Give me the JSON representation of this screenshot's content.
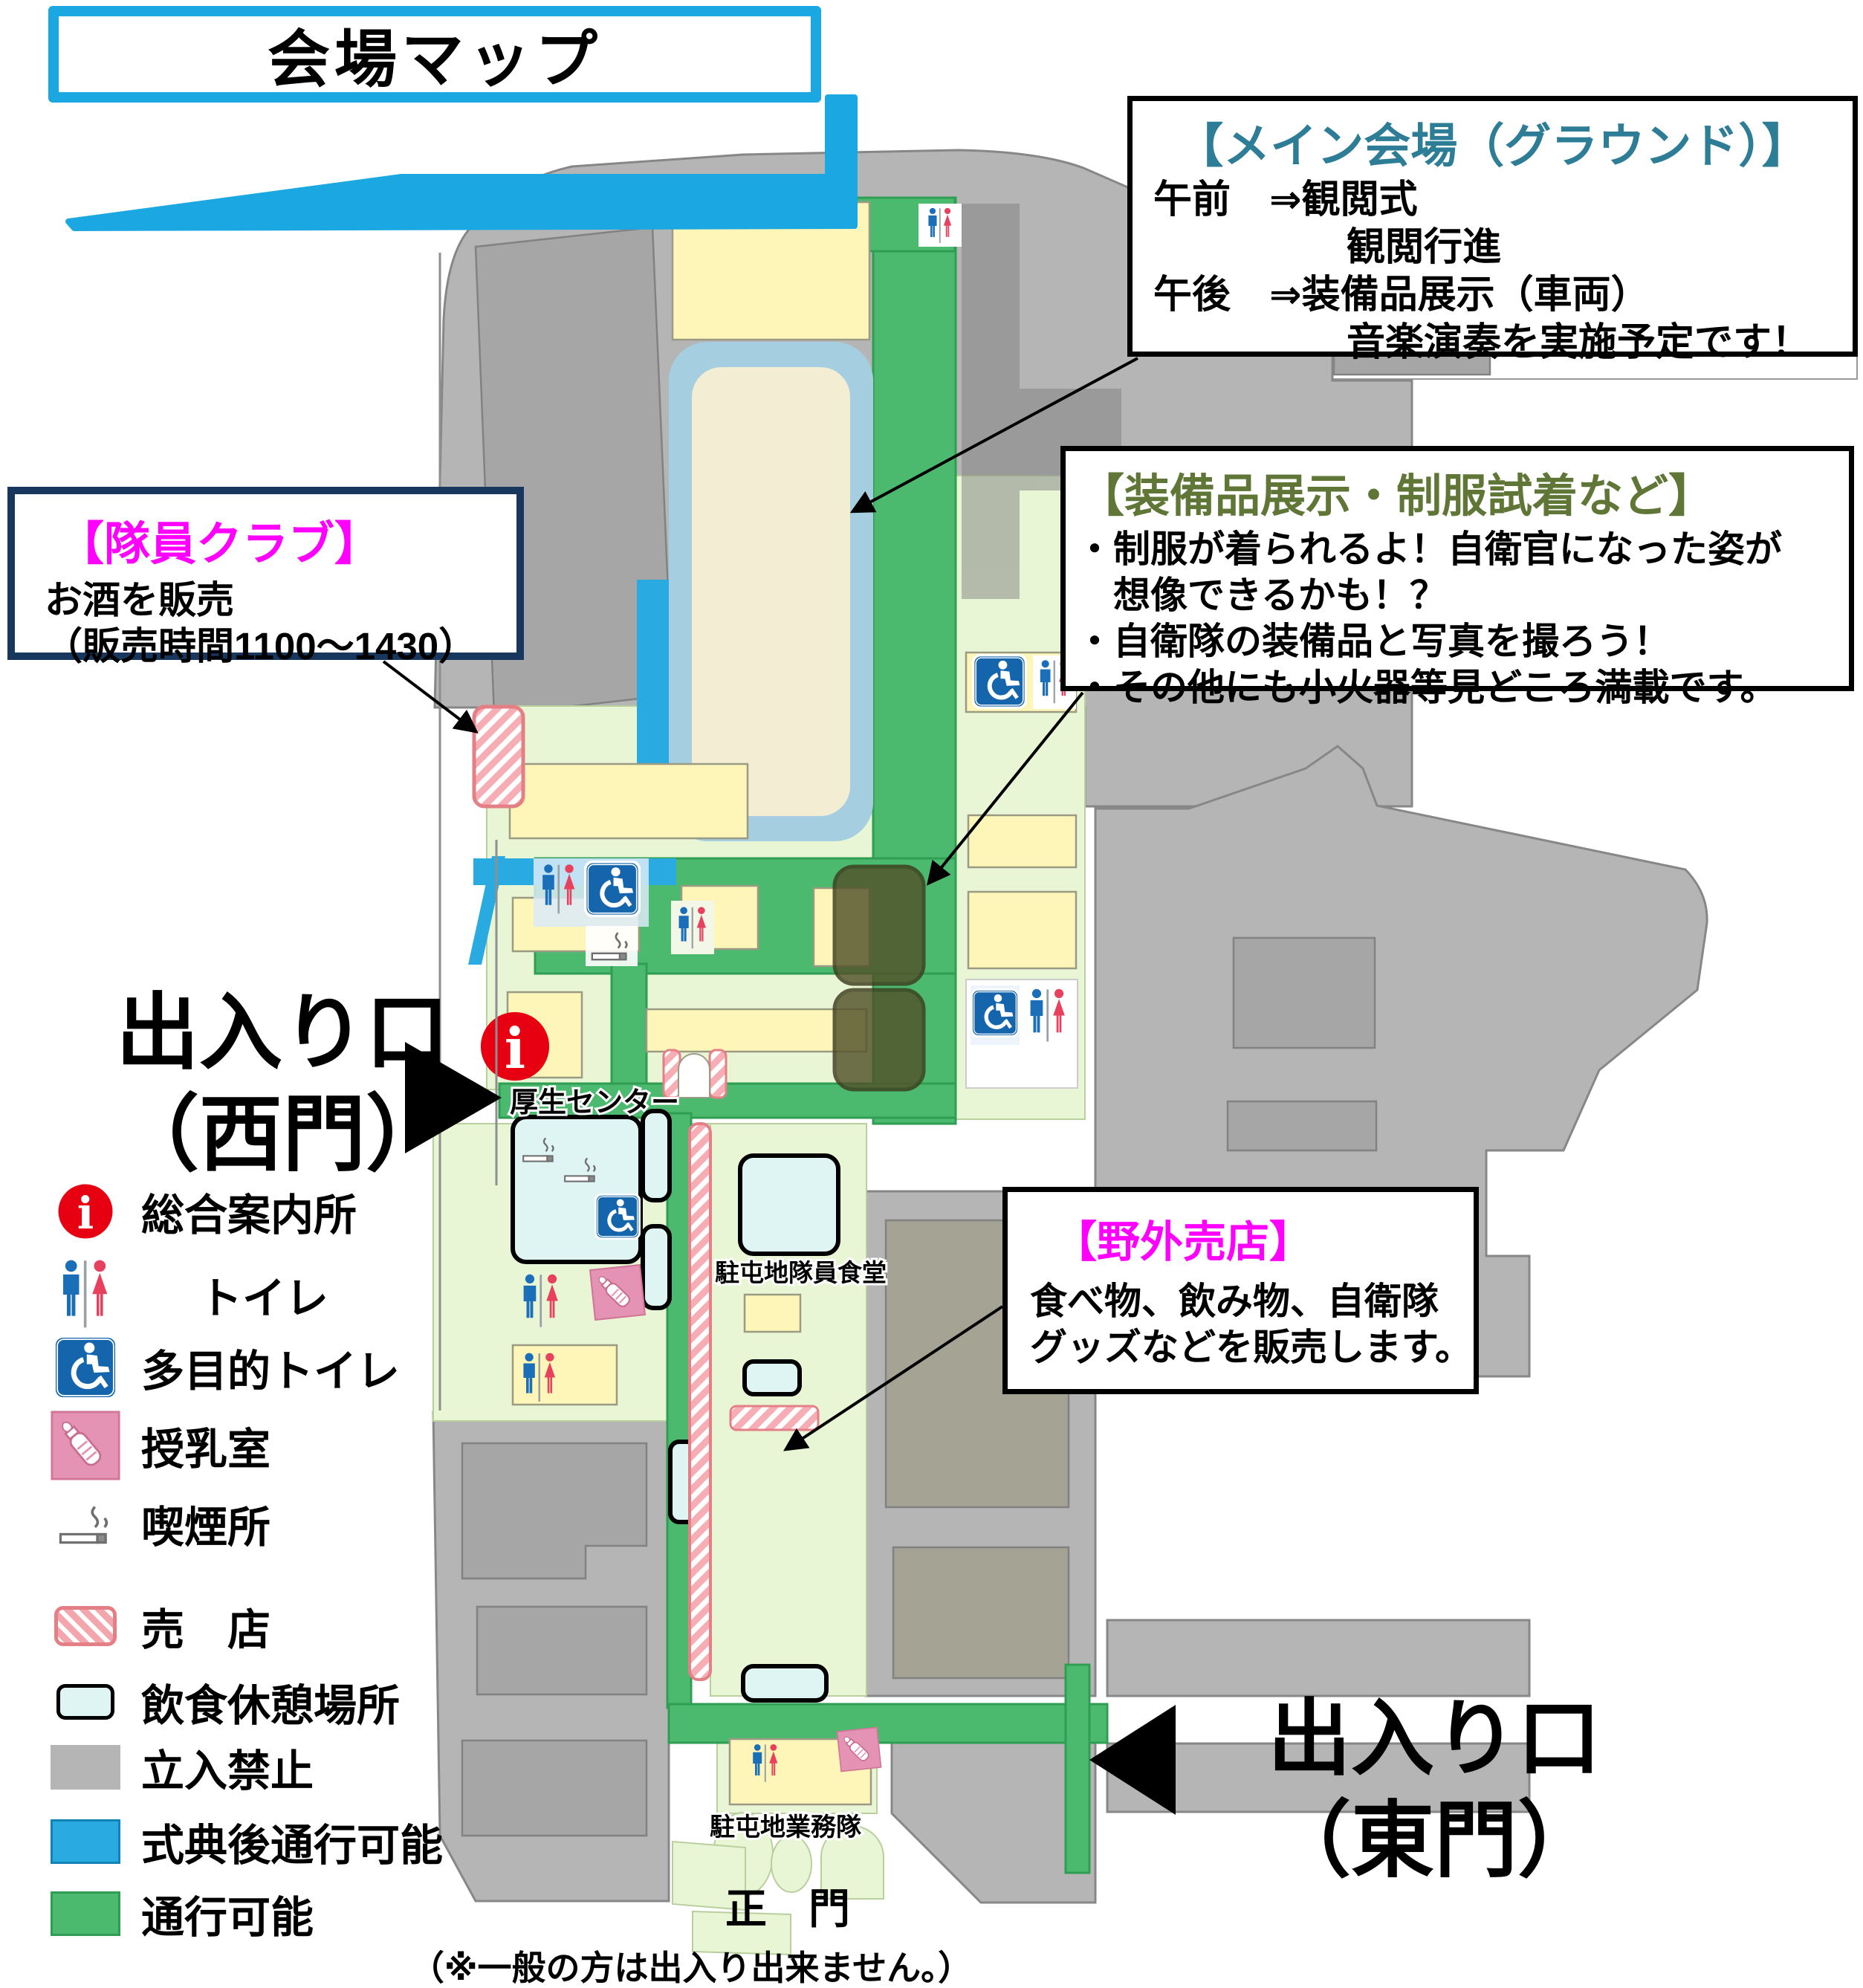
{
  "title": "会場マップ",
  "boxes": {
    "main_venue": {
      "title": "【メイン会場（グラウンド）】",
      "lines": [
        "午前　⇒観閲式",
        "　　　　　観閲行進",
        "午後　⇒装備品展示（車両）",
        "　　　　　音楽演奏を実施予定です！"
      ]
    },
    "equipment": {
      "title": "【装備品展示・制服試着など】",
      "lines": [
        "・制服が着られるよ！自衛官になった姿が",
        "　想像できるかも！？",
        "・自衛隊の装備品と写真を撮ろう！",
        "・その他にも小火器等見どころ満載です。"
      ]
    },
    "staff_club": {
      "title": "【隊員クラブ】",
      "lines": [
        "お酒を販売",
        "（販売時間1100～1430）"
      ]
    },
    "outdoor_shop": {
      "title": "【野外売店】",
      "lines": [
        "食べ物、飲み物、自衛隊",
        "グッズなどを販売します。"
      ]
    }
  },
  "gates": {
    "west": {
      "line1": "出入り口",
      "line2": "（西門）"
    },
    "east": {
      "line1": "出入り口",
      "line2": "（東門）"
    },
    "main": {
      "label": "正　門",
      "note": "（※一般の方は出入り出来ません。）"
    }
  },
  "map_labels": {
    "welfare_center": "厚生センター",
    "dining_hall": "駐屯地隊員食堂",
    "base_service_unit": "駐屯地業務隊"
  },
  "legend": [
    {
      "icon": "info-icon",
      "label": "総合案内所"
    },
    {
      "icon": "toilet-icon",
      "label": "トイレ"
    },
    {
      "icon": "accessible-toilet-icon",
      "label": "多目的トイレ"
    },
    {
      "icon": "nursing-room-icon",
      "label": "授乳室"
    },
    {
      "icon": "smoking-area-icon",
      "label": "喫煙所"
    },
    {
      "icon": "shop-swatch",
      "label": "売　店"
    },
    {
      "icon": "rest-area-swatch",
      "label": "飲食休憩場所"
    },
    {
      "icon": "no-entry-swatch",
      "label": "立入禁止"
    },
    {
      "icon": "after-ceremony-swatch",
      "label": "式典後通行可能"
    },
    {
      "icon": "walkable-swatch",
      "label": "通行可能"
    }
  ],
  "colors": {
    "accent_blue": "#1ba7e1",
    "teal_title": "#2e7d96",
    "olive_title": "#5f7637",
    "magenta_title": "#ff00ff",
    "info_red": "#e60012",
    "walkable_green": "#4cba6e",
    "after_ceremony_blue": "#29abe2",
    "no_entry_gray": "#b5b5b5"
  }
}
